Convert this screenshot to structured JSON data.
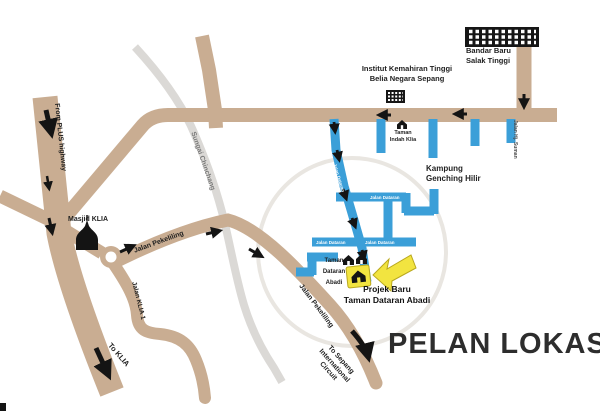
{
  "map": {
    "title": "PELAN LOKASI",
    "project": {
      "line1": "Projek Baru",
      "line2": "Taman Dataran Abadi"
    },
    "places": {
      "bandar_baru": {
        "line1": "Bandar Baru",
        "line2": "Salak Tinggi"
      },
      "institut": {
        "line1": "Institut Kemahiran Tinggi",
        "line2": "Belia Negara Sepang"
      },
      "kampung": {
        "line1": "Kampung",
        "line2": "Genching Hilir"
      },
      "taman_indah": {
        "line1": "Taman",
        "line2": "Indah Klia"
      },
      "taman_dataran": {
        "line1": "Taman",
        "line2": "Dataran",
        "line3": "Abadi"
      },
      "masjid": "Masjid KLIA"
    },
    "roads": {
      "from_plus": "From PLUS highway",
      "to_klia": "To KLIA",
      "jalan_klia_1": "Jalan KLIA 1",
      "jalan_pekeliling_a": "Jalan Pekeliling",
      "jalan_pekeliling_b": "Jalan Pekeliling",
      "jalan_hj_suman": "Jalan Hj. Suman",
      "to_sepang": {
        "line1": "To Sepang",
        "line2": "International",
        "line3": "Circuit"
      },
      "street_1": "Jalan Dataran",
      "street_2": "Jalan Dataran",
      "street_3": "Jalan Dataran",
      "street_4": "Jalan Dataran"
    },
    "river": "Sungai Chinchang",
    "colors": {
      "road_tan": "#c9ad92",
      "street_blue": "#3b9fd8",
      "river_gray": "#dbd9d6",
      "highlight_gray": "#e9e6e1",
      "accent_yellow": "#f2e440",
      "ink": "#141414"
    }
  }
}
